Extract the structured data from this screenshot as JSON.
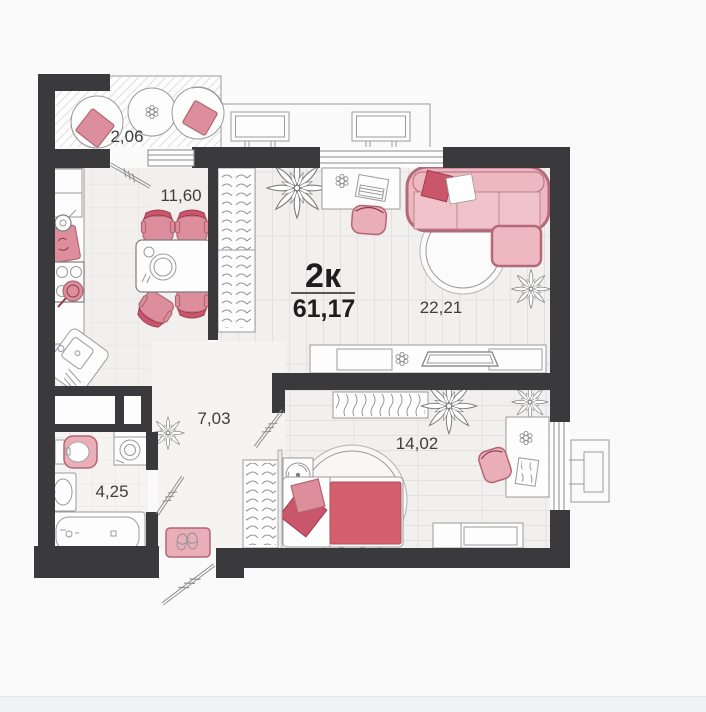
{
  "plan": {
    "type_label": "2к",
    "total_area": "61,17",
    "rooms": {
      "balcony": {
        "area": "2,06"
      },
      "kitchen": {
        "area": "11,60"
      },
      "living": {
        "area": "22,21"
      },
      "hallway": {
        "area": "7,03"
      },
      "bedroom": {
        "area": "14,02"
      },
      "bathroom": {
        "area": "4,25"
      }
    }
  },
  "icons": [
    "sofa-icon",
    "rug-icon",
    "desk-icon",
    "laptop-icon",
    "office-chair-icon",
    "tv-console-icon",
    "tv-icon",
    "books-icon",
    "wardrobe-icon",
    "plant-icon",
    "bed-icon",
    "pillow-icon",
    "blanket-icon",
    "fan-icon",
    "dresser-icon",
    "dining-table-icon",
    "dining-chair-icon",
    "stove-icon",
    "pan-icon",
    "kitchen-sink-icon",
    "cutting-board-icon",
    "kettle-icon",
    "fridge-icon",
    "toilet-icon",
    "washing-machine-icon",
    "bathroom-sink-icon",
    "bathtub-icon",
    "door-swing-icon",
    "window-icon",
    "window-marker-icon",
    "ac-ledge-icon",
    "balcony-chair-icon",
    "balcony-table-icon",
    "doormat-icon",
    "slippers-icon",
    "vent-shaft-icon"
  ],
  "theme": {
    "bg": "#fbfafa",
    "wall": "#3a3a3c",
    "floor": "#f1f0ef",
    "floor_light": "#f5f4f3",
    "line": "#e3e1e0",
    "outline": "#9a9a9a",
    "accent": "#e9aeb8",
    "accent_mid": "#dd8e9c",
    "accent_border": "#b26672",
    "accent_deep": "#c9566a",
    "text": "#3e3e40",
    "text_strong": "#1e1e20",
    "footer": "#f1f2f5"
  }
}
